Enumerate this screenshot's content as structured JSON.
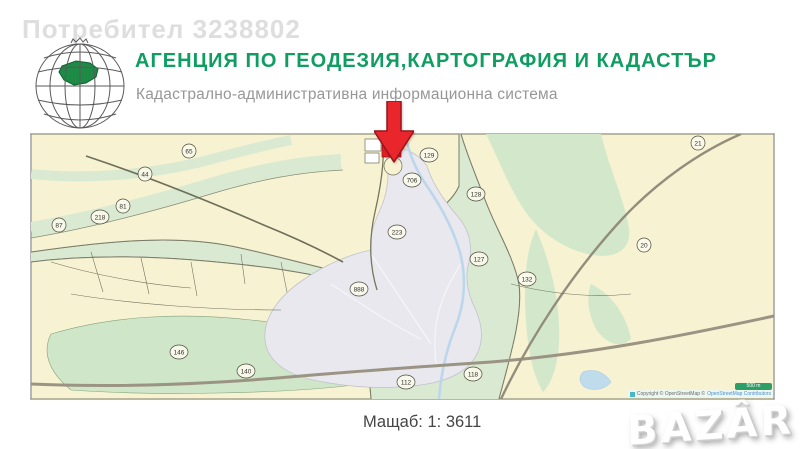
{
  "watermark": {
    "user": "Потребител 3238802",
    "brand": "BAZÂR"
  },
  "header": {
    "title": "АГЕНЦИЯ ПО ГЕОДЕЗИЯ,КАРТОГРАФИЯ И КАДАСТЪР",
    "subtitle": "Кадастрално-административна информационна система"
  },
  "map": {
    "scale_label": "Мащаб: 1: 3611",
    "scalebar_label": "500 m",
    "copyright_prefix": "Copyright © OpenStreetMap © ",
    "copyright_link": "OpenStreetMap Contributors",
    "labels": [
      {
        "text": "65",
        "x": 158,
        "y": 17
      },
      {
        "text": "44",
        "x": 114,
        "y": 40
      },
      {
        "text": "81",
        "x": 92,
        "y": 72
      },
      {
        "text": "218",
        "x": 69,
        "y": 83
      },
      {
        "text": "87",
        "x": 28,
        "y": 91
      },
      {
        "text": "129",
        "x": 398,
        "y": 21
      },
      {
        "text": "706",
        "x": 381,
        "y": 46
      },
      {
        "text": "128",
        "x": 445,
        "y": 60
      },
      {
        "text": "223",
        "x": 366,
        "y": 98
      },
      {
        "text": "127",
        "x": 448,
        "y": 125
      },
      {
        "text": "132",
        "x": 496,
        "y": 145
      },
      {
        "text": "888",
        "x": 328,
        "y": 155
      },
      {
        "text": "21",
        "x": 667,
        "y": 9
      },
      {
        "text": "20",
        "x": 613,
        "y": 111
      },
      {
        "text": "146",
        "x": 148,
        "y": 218
      },
      {
        "text": "140",
        "x": 215,
        "y": 237
      },
      {
        "text": "112",
        "x": 375,
        "y": 248
      },
      {
        "text": "118",
        "x": 442,
        "y": 240
      }
    ]
  },
  "icons": {
    "marker": "red-down-arrow-marker",
    "logo": "wireframe-globe-bulgaria"
  },
  "colors": {
    "brand_green": "#0f9d62",
    "marker_red": "#e31e24",
    "map_background": "#d9e9d2",
    "parcel_cream": "#f7f2d2",
    "urban_gray": "#e8e8ee",
    "water_blue": "#bcd7ec",
    "watermark_gray": "#dedede"
  }
}
